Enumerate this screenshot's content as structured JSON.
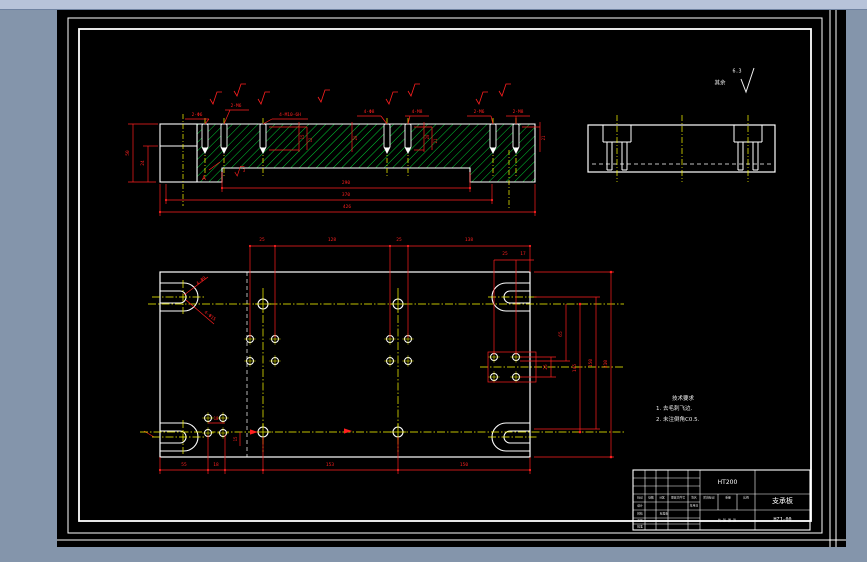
{
  "colors": {
    "d": "#ff1f1f",
    "w": "#f0f0f0",
    "y": "#ffff00",
    "hatch": "#00cc33",
    "line": "#ffffff",
    "sheet": "#000000",
    "surround": "#8495ab",
    "top_strip": "#b7c3d9"
  },
  "surface_note": {
    "prefix": "其余",
    "roughness": "6.3"
  },
  "tech_notes": {
    "title": "技术要求",
    "line1": "1. 去毛刺飞边.",
    "line2": "2. 未注倒角C0.5."
  },
  "title_block": {
    "material": "HT200",
    "part_name": "支承板",
    "drawing_no": "HZJ-00"
  },
  "annotations": [
    {
      "t": "2-Φ6",
      "x": 197,
      "y": 116
    },
    {
      "t": "2-M6",
      "x": 236,
      "y": 107
    },
    {
      "t": "4-M10-6H",
      "x": 290,
      "y": 116
    },
    {
      "t": "4-Φ8",
      "x": 369,
      "y": 113
    },
    {
      "t": "4-M8",
      "x": 417,
      "y": 113
    },
    {
      "t": "2-M6",
      "x": 479,
      "y": 113
    },
    {
      "t": "2-M8",
      "x": 518,
      "y": 113
    },
    {
      "t": "50",
      "x": 129,
      "y": 153,
      "r": -90
    },
    {
      "t": "24",
      "x": 144,
      "y": 163,
      "r": -90
    },
    {
      "t": "15",
      "x": 303,
      "y": 137,
      "r": -90,
      "s": 4
    },
    {
      "t": "12",
      "x": 311,
      "y": 140,
      "r": -90,
      "s": 4
    },
    {
      "t": "20",
      "x": 356,
      "y": 138,
      "r": -90,
      "s": 4
    },
    {
      "t": "20",
      "x": 428,
      "y": 137,
      "r": -90,
      "s": 4
    },
    {
      "t": "21",
      "x": 436,
      "y": 141,
      "r": -90,
      "s": 4
    },
    {
      "t": "21",
      "x": 544,
      "y": 138,
      "r": -90,
      "s": 4
    },
    {
      "t": "290",
      "x": 346,
      "y": 184
    },
    {
      "t": "370",
      "x": 346,
      "y": 196
    },
    {
      "t": "426",
      "x": 347,
      "y": 208
    },
    {
      "t": "A",
      "x": 204,
      "y": 178,
      "s": 6.5
    },
    {
      "t": "3",
      "x": 244,
      "y": 171,
      "s": 4
    },
    {
      "t": "25",
      "x": 262,
      "y": 241
    },
    {
      "t": "128",
      "x": 332,
      "y": 241
    },
    {
      "t": "25",
      "x": 399,
      "y": 241
    },
    {
      "t": "138",
      "x": 469,
      "y": 241
    },
    {
      "t": "25",
      "x": 505,
      "y": 255
    },
    {
      "t": "17",
      "x": 523,
      "y": 255
    },
    {
      "t": "55",
      "x": 184,
      "y": 466
    },
    {
      "t": "18",
      "x": 216,
      "y": 466
    },
    {
      "t": "153",
      "x": 330,
      "y": 466
    },
    {
      "t": "150",
      "x": 464,
      "y": 466
    },
    {
      "t": "25",
      "x": 547,
      "y": 367,
      "r": -90
    },
    {
      "t": "65",
      "x": 562,
      "y": 334,
      "r": -90
    },
    {
      "t": "145",
      "x": 576,
      "y": 368,
      "r": -90
    },
    {
      "t": "150",
      "x": 592,
      "y": 363,
      "r": -90
    },
    {
      "t": "210",
      "x": 607,
      "y": 364,
      "r": -90
    },
    {
      "t": "18",
      "x": 216,
      "y": 419,
      "s": 4
    },
    {
      "t": "15",
      "x": 236,
      "y": 439,
      "r": -90,
      "s": 4
    },
    {
      "t": "4-Φ9",
      "x": 202,
      "y": 282,
      "r": -38
    },
    {
      "t": "4-Φ15",
      "x": 209,
      "y": 317,
      "r": 38
    },
    {
      "t": "其余",
      "x": 720,
      "y": 84,
      "c": "w",
      "s": 5.5
    },
    {
      "t": "6.3",
      "x": 737,
      "y": 72,
      "c": "w",
      "s": 5
    },
    {
      "t": "标记",
      "x": 640,
      "y": 498,
      "c": "w",
      "s": 2.8
    },
    {
      "t": "处数",
      "x": 651,
      "y": 498,
      "c": "w",
      "s": 2.8
    },
    {
      "t": "分区",
      "x": 662,
      "y": 498,
      "c": "w",
      "s": 2.8
    },
    {
      "t": "更改文件号",
      "x": 678,
      "y": 498,
      "c": "w",
      "s": 2.8
    },
    {
      "t": "签名",
      "x": 694,
      "y": 498,
      "c": "w",
      "s": 2.8
    },
    {
      "t": "设计",
      "x": 640,
      "y": 506,
      "c": "w",
      "s": 2.8
    },
    {
      "t": "校核",
      "x": 640,
      "y": 514,
      "c": "w",
      "s": 2.8
    },
    {
      "t": "工艺",
      "x": 640,
      "y": 521,
      "c": "w",
      "s": 2.8
    },
    {
      "t": "批准",
      "x": 640,
      "y": 527,
      "c": "w",
      "s": 2.8
    },
    {
      "t": "标准化",
      "x": 664,
      "y": 514,
      "c": "w",
      "s": 2.8
    },
    {
      "t": "年月日",
      "x": 694,
      "y": 506,
      "c": "w",
      "s": 2.8
    },
    {
      "t": "阶段标记",
      "x": 709,
      "y": 498,
      "c": "w",
      "s": 2.8
    },
    {
      "t": "重量",
      "x": 728,
      "y": 498,
      "c": "w",
      "s": 2.8
    },
    {
      "t": "比例",
      "x": 746,
      "y": 498,
      "c": "w",
      "s": 2.8
    },
    {
      "t": "共 张 第 张",
      "x": 727,
      "y": 521,
      "c": "w",
      "s": 3.2
    }
  ]
}
